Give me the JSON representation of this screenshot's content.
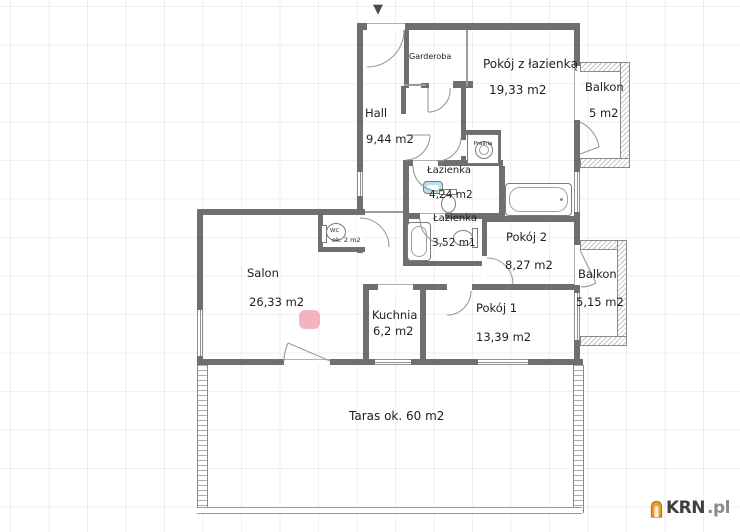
{
  "plan": {
    "marker": "▼",
    "rooms": {
      "garderoba": {
        "name": "Garderoba"
      },
      "pokoj_z_lazienka": {
        "name": "Pokój z łazienką",
        "area": "19,33 m2"
      },
      "balkon_gorny": {
        "name": "Balkon",
        "area": "5 m2"
      },
      "hall": {
        "name": "Hall",
        "area": "9,44 m2"
      },
      "pralnia": {
        "name": "Pralnia"
      },
      "lazienka_1": {
        "name": "Łazienka",
        "area": "4,24 m2"
      },
      "lazienka_2": {
        "name": "Łazienka",
        "area": "3,52 m1"
      },
      "pokoj_2": {
        "name": "Pokój 2",
        "area": "8,27 m2"
      },
      "balkon_dolny": {
        "name": "Balkon",
        "area": "5,15 m2"
      },
      "wc": {
        "name": "WC",
        "area": "ok. 2 m2"
      },
      "salon": {
        "name": "Salon",
        "area": "26,33 m2"
      },
      "kuchnia": {
        "name": "Kuchnia",
        "area": "6,2 m2"
      },
      "pokoj_1": {
        "name": "Pokój 1",
        "area": "13,39 m2"
      },
      "taras": {
        "name": "Taras",
        "area": "ok. 60 m2"
      }
    },
    "colors": {
      "wall": "#6f6f6f",
      "accent_pink": "#efa3ad",
      "sink_blue": "#b9e0f0",
      "logo_orange": "#f09d2e"
    },
    "watermark": {
      "brand": "KRN",
      "tld": ".pl"
    }
  }
}
